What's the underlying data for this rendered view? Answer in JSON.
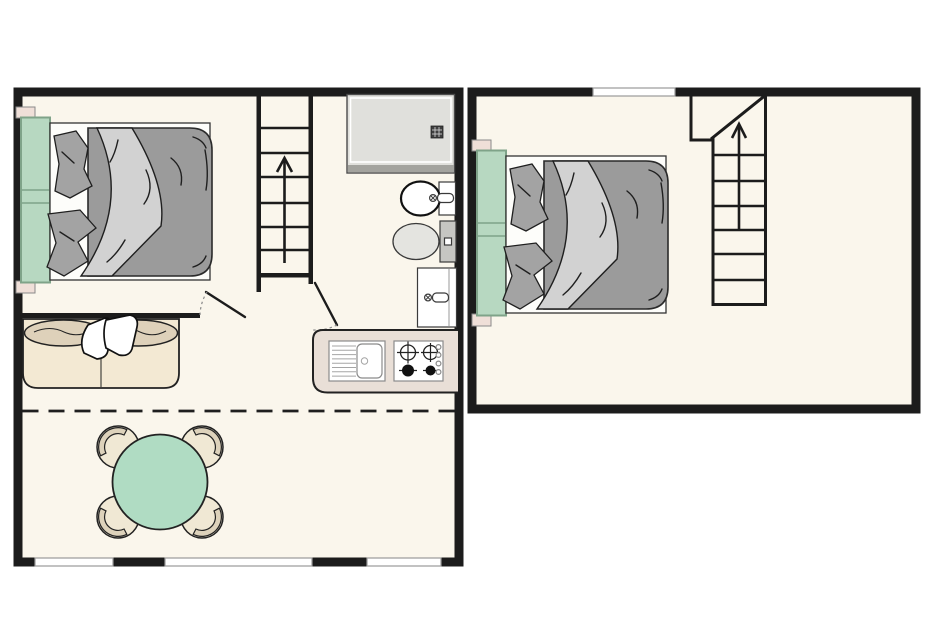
{
  "document": {
    "kind": "floor-plan-illustration",
    "panels": [
      {
        "name": "main-floor-plan",
        "position": "left",
        "features": [
          "double-bed",
          "nightstands",
          "staircase-up",
          "up-arrow",
          "shower-tray",
          "washbasin",
          "toilet",
          "vanity-basin",
          "interior-door",
          "bathroom-door",
          "kitchen-counter",
          "kitchen-sink",
          "gas-hob-4-burner",
          "sofa-with-pillows",
          "loft-edge-dashed-line",
          "round-dining-table",
          "four-chairs",
          "three-windows-bottom-wall"
        ]
      },
      {
        "name": "upper-floor-plan",
        "position": "right",
        "features": [
          "double-bed",
          "nightstands",
          "staircase-up",
          "up-arrow",
          "window-top-wall"
        ]
      }
    ],
    "stairs_direction": "up"
  },
  "colors": {
    "page_bg": "#ffffff",
    "wall": "#1c1c1c",
    "floor": "#faf6ec",
    "window": "#ffffff",
    "window_line": "#9a9a9a",
    "bed_duvet": "#9b9b9b",
    "bed_fold": "#d2d2d2",
    "bed_pillow": "#a3a3a3",
    "headboard": "#b7d8c1",
    "headboard_border": "#7fa389",
    "nightstand": "#efdfd8",
    "shower": "#e0e0dc",
    "shower_edge": "#a3a39e",
    "toilet_tank": "#c6c6c2",
    "counter": "#e9dfd7",
    "sofa_seat": "#f3e9d3",
    "sofa_back": "#ded1ba",
    "table": "#b0dcc3",
    "chair": "#f0e8d4",
    "chair_band": "#ddd2bb"
  }
}
